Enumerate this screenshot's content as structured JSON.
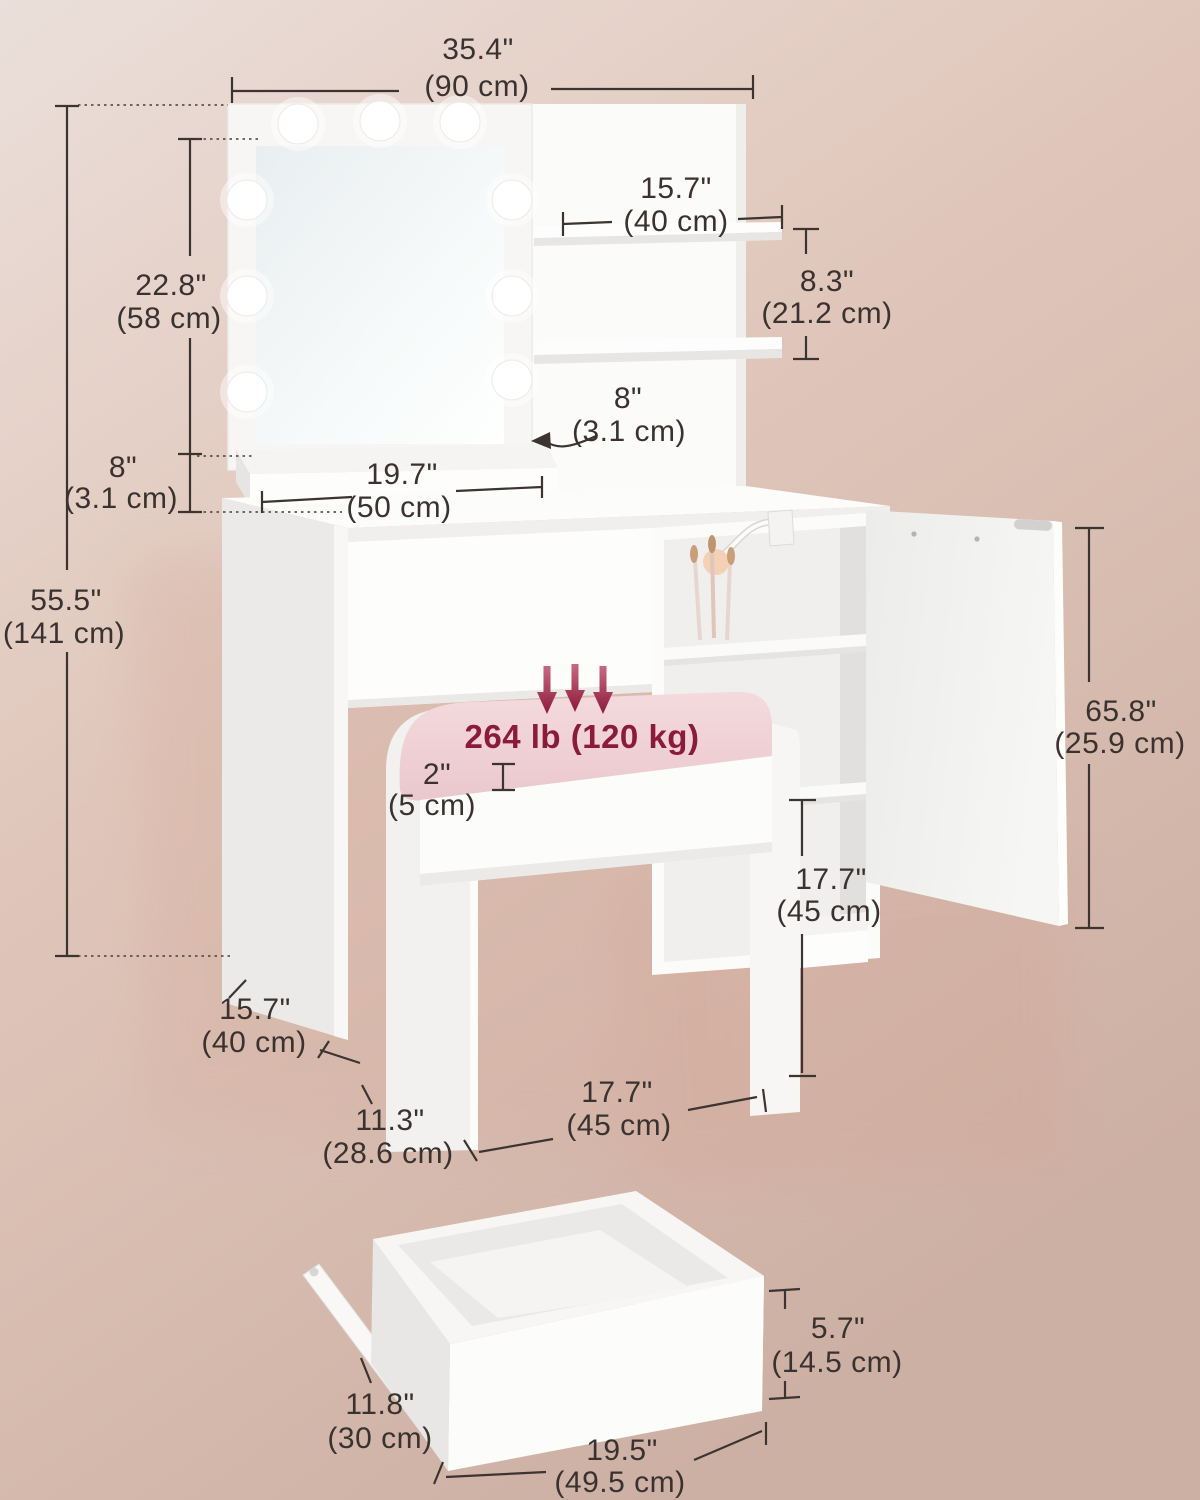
{
  "title": "vanity-table-dimension-diagram",
  "colors": {
    "accent_red": "#8b1b3a",
    "dimension_line": "#3c3431",
    "background_top": "#ebdfda",
    "background_bottom": "#cdb0a4",
    "cushion_pink": "#f3d7da",
    "furniture_white": "#fcfcfb"
  },
  "labels": {
    "overall_width_in": "35.4\"",
    "overall_width_cm": "(90 cm)",
    "total_height_in": "55.5\"",
    "total_height_cm": "(141 cm)",
    "mirror_height_in": "22.8\"",
    "mirror_height_cm": "(58 cm)",
    "riser_height_in": "8\"",
    "riser_height_cm": "(3.1 cm)",
    "shelf_length_in": "15.7\"",
    "shelf_length_cm": "(40 cm)",
    "shelf_spacing_in": "8.3\"",
    "shelf_spacing_cm": "(21.2 cm)",
    "shelf_thickness_in": "8\"",
    "shelf_thickness_cm": "(3.1 cm)",
    "riser_length_in": "19.7\"",
    "riser_length_cm": "(50 cm)",
    "weight_capacity": "264 lb (120 kg)",
    "cushion_thickness_in": "2\"",
    "cushion_thickness_cm": "(5 cm)",
    "door_width_in": "65.8\"",
    "door_width_cm": "(25.9 cm)",
    "compartment_height_in": "17.7\"",
    "compartment_height_cm": "(45 cm)",
    "desk_depth_in": "15.7\"",
    "desk_depth_cm": "(40 cm)",
    "stool_depth_in": "11.3\"",
    "stool_depth_cm": "(28.6 cm)",
    "stool_width_in": "17.7\"",
    "stool_width_cm": "(45 cm)",
    "drawer_height_in": "5.7\"",
    "drawer_height_cm": "(14.5 cm)",
    "drawer_depth_in": "11.8\"",
    "drawer_depth_cm": "(30 cm)",
    "drawer_width_in": "19.5\"",
    "drawer_width_cm": "(49.5 cm)"
  }
}
